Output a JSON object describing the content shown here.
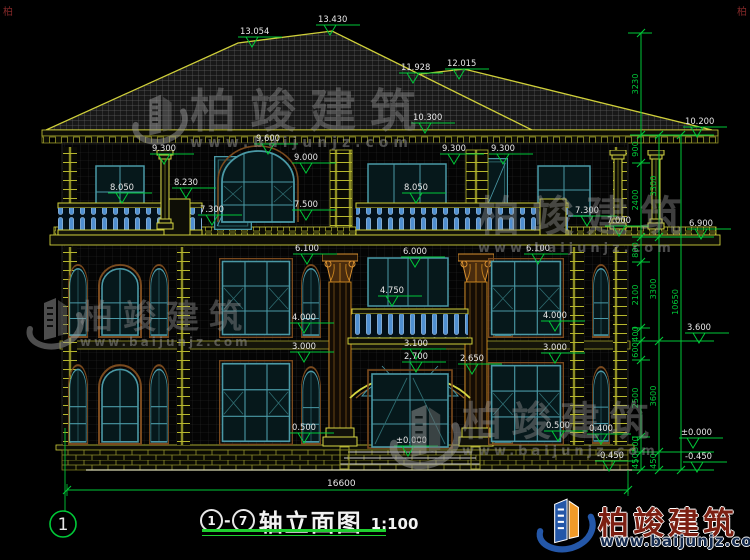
{
  "colors": {
    "background": "#000000",
    "dim_green": "#00c838",
    "label_white": "#e8e8e8",
    "cad_yellow": "#d6d642",
    "window_teal": "#4a99a6",
    "baluster_blue": "#5f9fd8",
    "column_brown": "#c8841e",
    "watermark_gray": "#8f8f8f",
    "logo_blue": "#2457a8",
    "logo_orange": "#f09a28",
    "logo_text_red": "#7c1f12"
  },
  "watermark": {
    "brand": "柏竣建筑",
    "url": "www.baijunjz.com"
  },
  "logo": {
    "brand": "柏竣建筑",
    "url": "www.baijunjz.com"
  },
  "corner_mark": "柏",
  "title_block": {
    "axis_from": "1",
    "axis_to": "7",
    "dash": "-",
    "name": "轴立面图",
    "scale": "1:100"
  },
  "drawing": {
    "axis_bubble": {
      "label": "1",
      "cx": 63,
      "cy": 524,
      "r": 13
    },
    "elevation_markers": [
      {
        "label": "13.054",
        "x": 242,
        "y": 34
      },
      {
        "label": "13.430",
        "x": 320,
        "y": 22
      },
      {
        "label": "11.928",
        "x": 403,
        "y": 70
      },
      {
        "label": "12.015",
        "x": 449,
        "y": 66
      },
      {
        "label": "10.300",
        "x": 415,
        "y": 120
      },
      {
        "label": "9.300",
        "x": 154,
        "y": 151
      },
      {
        "label": "9.600",
        "x": 258,
        "y": 141
      },
      {
        "label": "9.000",
        "x": 296,
        "y": 160
      },
      {
        "label": "9.300",
        "x": 444,
        "y": 151
      },
      {
        "label": "9.300",
        "x": 493,
        "y": 151
      },
      {
        "label": "8.050",
        "x": 112,
        "y": 190
      },
      {
        "label": "8.230",
        "x": 176,
        "y": 185
      },
      {
        "label": "8.050",
        "x": 406,
        "y": 190
      },
      {
        "label": "7.300",
        "x": 202,
        "y": 212
      },
      {
        "label": "7.500",
        "x": 296,
        "y": 207
      },
      {
        "label": "7.300",
        "x": 577,
        "y": 213
      },
      {
        "label": "7.000",
        "x": 609,
        "y": 223
      },
      {
        "label": "6.100",
        "x": 297,
        "y": 251
      },
      {
        "label": "6.000",
        "x": 405,
        "y": 254
      },
      {
        "label": "6.100",
        "x": 528,
        "y": 251
      },
      {
        "label": "4.750",
        "x": 382,
        "y": 293
      },
      {
        "label": "4.000",
        "x": 294,
        "y": 320
      },
      {
        "label": "3.000",
        "x": 294,
        "y": 349
      },
      {
        "label": "4.000",
        "x": 545,
        "y": 318
      },
      {
        "label": "3.000",
        "x": 545,
        "y": 350
      },
      {
        "label": "3.100",
        "x": 406,
        "y": 346
      },
      {
        "label": "2.700",
        "x": 406,
        "y": 359
      },
      {
        "label": "2.650",
        "x": 462,
        "y": 361
      },
      {
        "label": "0.500",
        "x": 294,
        "y": 430
      },
      {
        "label": "0.500",
        "x": 548,
        "y": 428
      },
      {
        "label": "0.400",
        "x": 591,
        "y": 431
      },
      {
        "label": "±0.000",
        "x": 398,
        "y": 443
      },
      {
        "label": "-0.450",
        "x": 599,
        "y": 458
      },
      {
        "label": "10.200",
        "x": 687,
        "y": 124
      },
      {
        "label": "6.900",
        "x": 691,
        "y": 226
      },
      {
        "label": "3.600",
        "x": 689,
        "y": 330
      },
      {
        "label": "±0.000",
        "x": 683,
        "y": 435
      },
      {
        "label": "-0.450",
        "x": 687,
        "y": 459
      }
    ],
    "dim_chains": [
      {
        "x": 641,
        "levels": [
          33,
          135,
          163,
          237,
          262,
          328,
          341,
          360,
          437,
          452,
          470
        ],
        "labels": [
          {
            "t": "3230",
            "y": 84
          },
          {
            "t": "900",
            "y": 149
          },
          {
            "t": "2400",
            "y": 200
          },
          {
            "t": "800",
            "y": 250
          },
          {
            "t": "2100",
            "y": 295
          },
          {
            "t": "400",
            "y": 334
          },
          {
            "t": "600",
            "y": 350
          },
          {
            "t": "2500",
            "y": 398
          },
          {
            "t": "500",
            "y": 444
          },
          {
            "t": "450",
            "y": 461
          }
        ]
      },
      {
        "x": 659,
        "levels": [
          135,
          237,
          341,
          452,
          470
        ],
        "labels": [
          {
            "t": "3300",
            "y": 186
          },
          {
            "t": "3300",
            "y": 289
          },
          {
            "t": "3600",
            "y": 396
          },
          {
            "t": "450",
            "y": 461
          }
        ]
      },
      {
        "x": 681,
        "levels": [
          135,
          470
        ],
        "labels": [
          {
            "t": "10650",
            "y": 302
          }
        ]
      }
    ],
    "bottom_dim": {
      "label": "16600",
      "x": 327,
      "y": 486,
      "x1": 67,
      "x2": 628,
      "y_line": 490
    }
  }
}
